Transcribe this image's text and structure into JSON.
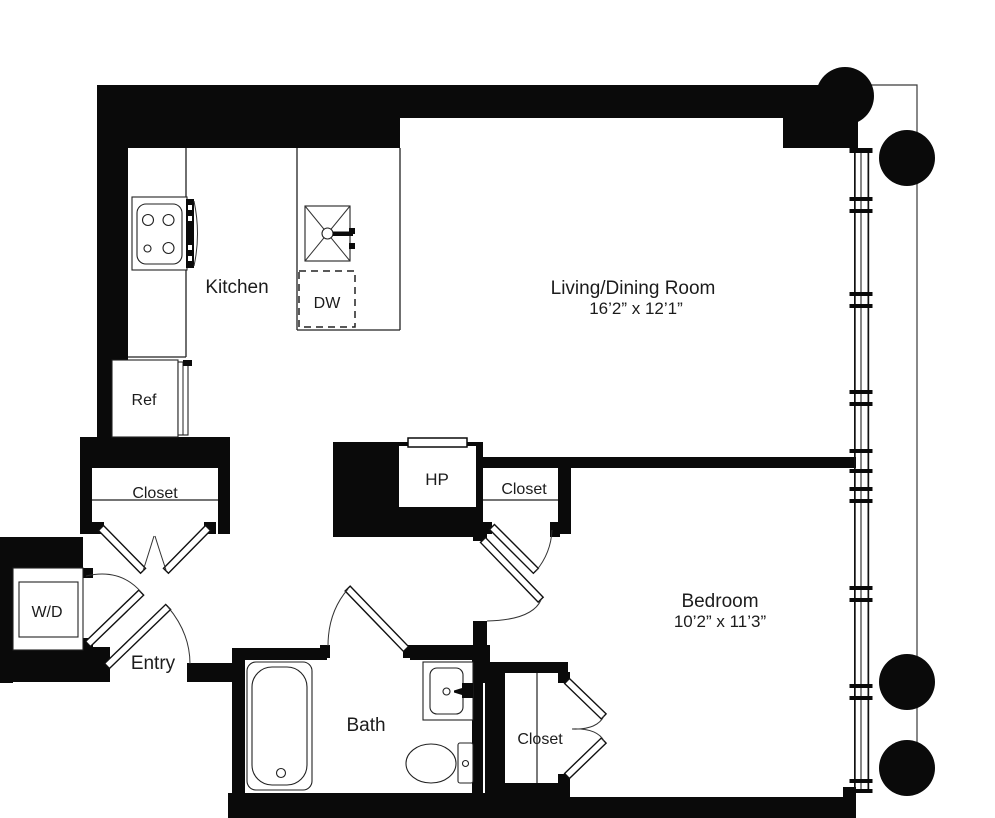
{
  "plan": {
    "rooms": {
      "kitchen": {
        "label": "Kitchen"
      },
      "living": {
        "label": "Living/Dining Room",
        "dimensions": "16’2” x 12’1”"
      },
      "bedroom": {
        "label": "Bedroom",
        "dimensions": "10’2” x 11’3”"
      },
      "bath": {
        "label": "Bath"
      },
      "entry": {
        "label": "Entry"
      }
    },
    "closets": {
      "entry_closet": {
        "label": "Closet"
      },
      "hall_closet": {
        "label": "Closet"
      },
      "bedroom_closet": {
        "label": "Closet"
      }
    },
    "fixtures": {
      "dishwasher": {
        "label": "DW"
      },
      "refrigerator": {
        "label": "Ref"
      },
      "washer_dryer": {
        "label": "W/D"
      },
      "heat_pump": {
        "label": "HP"
      }
    },
    "colors": {
      "wall": "#0a0a0a",
      "line": "#222222",
      "background": "#ffffff"
    }
  }
}
